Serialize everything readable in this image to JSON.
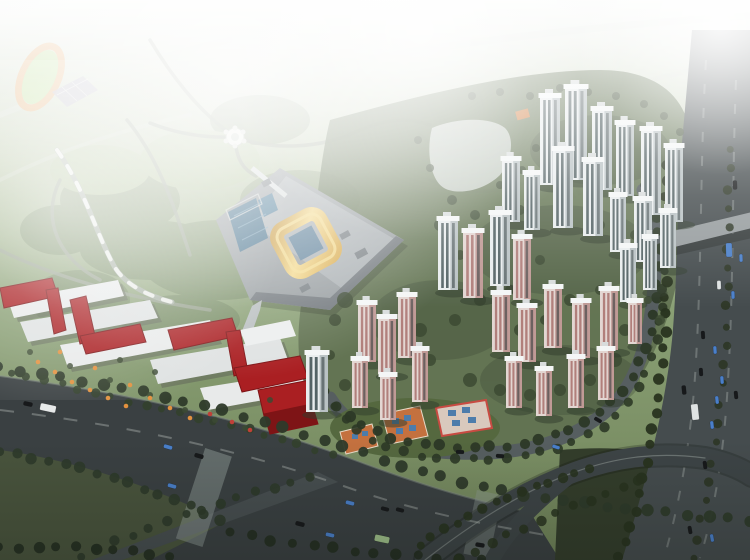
{
  "palette": {
    "skyHaze": "#f2f5f0",
    "parkGreen": "#8ba177",
    "parkDark": "#4f6442",
    "parkLight": "#a9c18b",
    "devGreen": "#5f7050",
    "grassDark": "#49543d",
    "interGrass": "#333d2b",
    "roadMain": "#3a4042",
    "roadLocal": "#565e60",
    "roadHighway": "#454c4e",
    "roadBranch": "#474e50",
    "roadFaint": "#d7ddd4",
    "overpass": "#969c9e",
    "pathGray": "#9aa393",
    "trackRing": "#e8a96a",
    "trackInfield": "#b8dc8e",
    "courts": "#b7b4c4",
    "platform": "#979da0",
    "platformRoof": "#aab0b3",
    "goldRoof": "#e3b75c",
    "goldHighlight": "#f4dc8f",
    "atriumBlue": "#5d8099",
    "poolBlue": "#3f6c88",
    "redBlock": "#aa1f22",
    "redBlockDark": "#7e1416",
    "whiteBuilding": "#e8eaea",
    "kinderRoof": "#c4713f",
    "kinderPanel": "#4d7cab",
    "kinderTrim": "#c84b42",
    "plaza": "#cdd3cc",
    "umbrellaOrange": "#e2913f",
    "umbrellaRed": "#c04038",
    "treeDark": "#2e3a2a",
    "treeMid": "#33402c",
    "towerWhiteFace": "#e9edee",
    "towerWhiteSide": "#b9c2c4",
    "towerGlass": "#3a4a4c",
    "towerPinkFace": "#e3d6d2",
    "towerPinkSide": "#c09a96",
    "towerPinkStripe": "#a8706c",
    "towerRoof": "#f4f6f6",
    "laneLine": "#c8cdc9",
    "townhouse": "#7f8d7f"
  },
  "carColors": {
    "d": "#17191b",
    "b": "#4a7fc9",
    "w": "#dfe3e3",
    "t": "#e6e9e9",
    "g": "#9fc08a"
  },
  "scene": {
    "towers": [
      [
        540,
        185,
        20,
        88,
        "w"
      ],
      [
        565,
        180,
        22,
        92,
        "w"
      ],
      [
        592,
        190,
        20,
        80,
        "w"
      ],
      [
        616,
        196,
        18,
        72,
        "w"
      ],
      [
        641,
        215,
        20,
        85,
        "w"
      ],
      [
        502,
        222,
        18,
        62,
        "w"
      ],
      [
        665,
        222,
        18,
        75,
        "w"
      ],
      [
        553,
        228,
        20,
        78,
        "w"
      ],
      [
        524,
        230,
        16,
        56,
        "w"
      ],
      [
        583,
        236,
        20,
        75,
        "w"
      ],
      [
        610,
        252,
        16,
        56,
        "w"
      ],
      [
        634,
        262,
        18,
        62,
        "w"
      ],
      [
        660,
        268,
        16,
        56,
        "w"
      ],
      [
        490,
        286,
        20,
        72,
        "w"
      ],
      [
        438,
        290,
        20,
        70,
        "w"
      ],
      [
        643,
        290,
        14,
        52,
        "w"
      ],
      [
        463,
        298,
        20,
        66,
        "p"
      ],
      [
        513,
        300,
        18,
        62,
        "p"
      ],
      [
        620,
        302,
        16,
        55,
        "w"
      ],
      [
        628,
        344,
        14,
        42,
        "p"
      ],
      [
        544,
        348,
        18,
        60,
        "p"
      ],
      [
        600,
        350,
        18,
        60,
        "p"
      ],
      [
        492,
        352,
        18,
        58,
        "p"
      ],
      [
        358,
        362,
        18,
        58,
        "p"
      ],
      [
        572,
        358,
        18,
        56,
        "p"
      ],
      [
        398,
        358,
        18,
        62,
        "p"
      ],
      [
        518,
        362,
        18,
        55,
        "p"
      ],
      [
        378,
        374,
        18,
        56,
        "p"
      ],
      [
        598,
        400,
        16,
        50,
        "p"
      ],
      [
        412,
        402,
        16,
        52,
        "p"
      ],
      [
        568,
        408,
        16,
        50,
        "p"
      ],
      [
        352,
        408,
        16,
        48,
        "p"
      ],
      [
        506,
        408,
        16,
        48,
        "p"
      ],
      [
        306,
        412,
        22,
        58,
        "w"
      ],
      [
        536,
        416,
        16,
        46,
        "p"
      ],
      [
        380,
        420,
        16,
        44,
        "p"
      ]
    ],
    "treeLines": [
      {
        "d": "M0,368 C150,388 260,418 360,452 C460,488 560,505 750,520",
        "n": 38,
        "r": 5,
        "c": "#2e3a2a",
        "o": 0.95
      },
      {
        "d": "M0,452 C70,462 150,486 220,520",
        "n": 15,
        "r": 4.5,
        "c": "#2e3a2a",
        "o": 0.9
      },
      {
        "d": "M80,556 C150,525 230,498 310,478",
        "n": 14,
        "r": 4,
        "c": "#2e3a2a",
        "o": 0.9
      },
      {
        "d": "M0,548 C60,546 120,548 170,556",
        "n": 10,
        "r": 4.5,
        "c": "#242e20",
        "o": 0.9
      },
      {
        "d": "M230,532 C320,550 420,558 480,560",
        "n": 13,
        "r": 4.5,
        "c": "#242e20",
        "o": 0.9
      },
      {
        "d": "M10,372 C80,390 160,408 240,428 C280,438 310,448 332,454",
        "n": 20,
        "r": 3.5,
        "c": "#33402c",
        "o": 0.9
      },
      {
        "d": "M326,392 C346,424 388,442 440,446 C520,452 566,437 604,409 C642,380 656,326 659,268 C661,228 656,202 646,186",
        "n": 34,
        "r": 4.5,
        "c": "#2c3826",
        "o": 0.95
      },
      {
        "d": "M334,406 C352,436 392,454 442,458 C522,464 572,449 610,421 C648,392 662,332 665,272",
        "n": 28,
        "r": 4,
        "c": "#2c3826",
        "o": 0.9
      },
      {
        "d": "M668,148 C664,230 668,300 662,370 C655,430 640,500 620,558",
        "n": 26,
        "r": 4.5,
        "c": "#28331f",
        "o": 0.95
      },
      {
        "d": "M731,150 C727,230 729,310 722,390 C716,450 704,510 692,558",
        "n": 22,
        "r": 3.5,
        "c": "#2c3626",
        "o": 0.9
      },
      {
        "d": "M420,545 C470,512 530,484 590,470",
        "n": 14,
        "r": 4,
        "c": "#28331f",
        "o": 0.9
      },
      {
        "d": "M460,560 C510,532 570,505 640,482",
        "n": 12,
        "r": 4,
        "c": "#28331f",
        "o": 0.85
      }
    ],
    "treeClusters": [
      [
        345,
        300,
        8
      ],
      [
        335,
        320,
        6
      ],
      [
        420,
        330,
        7
      ],
      [
        455,
        320,
        6
      ],
      [
        430,
        360,
        6
      ],
      [
        470,
        380,
        7
      ],
      [
        500,
        390,
        6
      ],
      [
        530,
        395,
        6
      ],
      [
        560,
        390,
        6
      ],
      [
        590,
        380,
        6
      ],
      [
        615,
        360,
        7
      ],
      [
        625,
        330,
        6
      ],
      [
        520,
        330,
        6
      ],
      [
        545,
        320,
        5
      ],
      [
        480,
        300,
        6
      ],
      [
        510,
        290,
        5
      ],
      [
        570,
        300,
        6
      ],
      [
        600,
        290,
        5
      ],
      [
        630,
        270,
        6
      ],
      [
        540,
        260,
        5
      ],
      [
        500,
        255,
        6
      ],
      [
        460,
        255,
        5
      ],
      [
        440,
        225,
        6
      ],
      [
        475,
        215,
        5
      ],
      [
        520,
        210,
        5
      ],
      [
        560,
        215,
        5
      ],
      [
        600,
        225,
        5
      ],
      [
        635,
        235,
        5
      ],
      [
        345,
        385,
        6
      ],
      [
        330,
        355,
        5
      ],
      [
        660,
        320,
        5
      ],
      [
        648,
        300,
        4
      ],
      [
        418,
        140,
        4
      ],
      [
        452,
        200,
        5
      ],
      [
        430,
        168,
        4
      ],
      [
        500,
        185,
        4
      ],
      [
        522,
        170,
        4
      ],
      [
        536,
        148,
        4
      ],
      [
        472,
        96,
        4
      ],
      [
        500,
        92,
        4
      ],
      [
        530,
        96,
        4
      ],
      [
        560,
        88,
        4
      ],
      [
        588,
        92,
        4
      ],
      [
        616,
        96,
        4
      ],
      [
        644,
        104,
        4
      ],
      [
        664,
        116,
        4
      ],
      [
        680,
        132,
        4
      ],
      [
        30,
        352,
        3
      ],
      [
        70,
        366,
        3
      ],
      [
        110,
        380,
        3
      ],
      [
        150,
        395,
        3
      ],
      [
        185,
        410,
        3
      ],
      [
        215,
        420,
        3
      ],
      [
        245,
        428,
        3
      ],
      [
        270,
        400,
        3
      ],
      [
        155,
        372,
        3
      ],
      [
        120,
        360,
        3
      ]
    ],
    "cars": [
      [
        28,
        404,
        12,
        9,
        "d"
      ],
      [
        48,
        408,
        12,
        16,
        "t"
      ],
      [
        168,
        447,
        16,
        9,
        "b"
      ],
      [
        199,
        456,
        16,
        9,
        "d"
      ],
      [
        172,
        486,
        16,
        9,
        "b"
      ],
      [
        350,
        503,
        14,
        9,
        "b"
      ],
      [
        385,
        509,
        14,
        8,
        "d"
      ],
      [
        400,
        510,
        14,
        8,
        "d"
      ],
      [
        300,
        524,
        14,
        9,
        "d"
      ],
      [
        330,
        535,
        13,
        9,
        "b"
      ],
      [
        382,
        539,
        12,
        15,
        "g"
      ],
      [
        480,
        545,
        10,
        9,
        "d"
      ],
      [
        598,
        420,
        30,
        8,
        "d"
      ],
      [
        556,
        447,
        18,
        8,
        "b"
      ],
      [
        500,
        456,
        5,
        8,
        "d"
      ],
      [
        460,
        452,
        2,
        8,
        "d"
      ],
      [
        735,
        185,
        88,
        9,
        "d"
      ],
      [
        729,
        250,
        88,
        14,
        "b"
      ],
      [
        741,
        258,
        88,
        8,
        "b"
      ],
      [
        719,
        285,
        88,
        9,
        "w"
      ],
      [
        733,
        295,
        88,
        8,
        "b"
      ],
      [
        703,
        335,
        86,
        8,
        "d"
      ],
      [
        715,
        350,
        86,
        8,
        "b"
      ],
      [
        701,
        372,
        86,
        8,
        "d"
      ],
      [
        722,
        380,
        86,
        8,
        "b"
      ],
      [
        684,
        390,
        84,
        9,
        "d"
      ],
      [
        717,
        400,
        84,
        8,
        "b"
      ],
      [
        695,
        412,
        84,
        16,
        "w"
      ],
      [
        712,
        425,
        84,
        8,
        "b"
      ],
      [
        736,
        395,
        84,
        8,
        "d"
      ],
      [
        705,
        465,
        82,
        8,
        "d"
      ],
      [
        690,
        530,
        80,
        8,
        "d"
      ],
      [
        712,
        538,
        80,
        8,
        "b"
      ]
    ],
    "umbrellas": [
      [
        38,
        362,
        "o"
      ],
      [
        55,
        372,
        "o"
      ],
      [
        72,
        382,
        "o"
      ],
      [
        90,
        390,
        "o"
      ],
      [
        108,
        398,
        "o"
      ],
      [
        126,
        406,
        "o"
      ],
      [
        60,
        352,
        "o"
      ],
      [
        95,
        368,
        "o"
      ],
      [
        130,
        385,
        "o"
      ],
      [
        150,
        398,
        "o"
      ],
      [
        170,
        408,
        "o"
      ],
      [
        190,
        418,
        "o"
      ],
      [
        210,
        414,
        "r"
      ],
      [
        232,
        422,
        "r"
      ],
      [
        250,
        430,
        "r"
      ]
    ]
  }
}
